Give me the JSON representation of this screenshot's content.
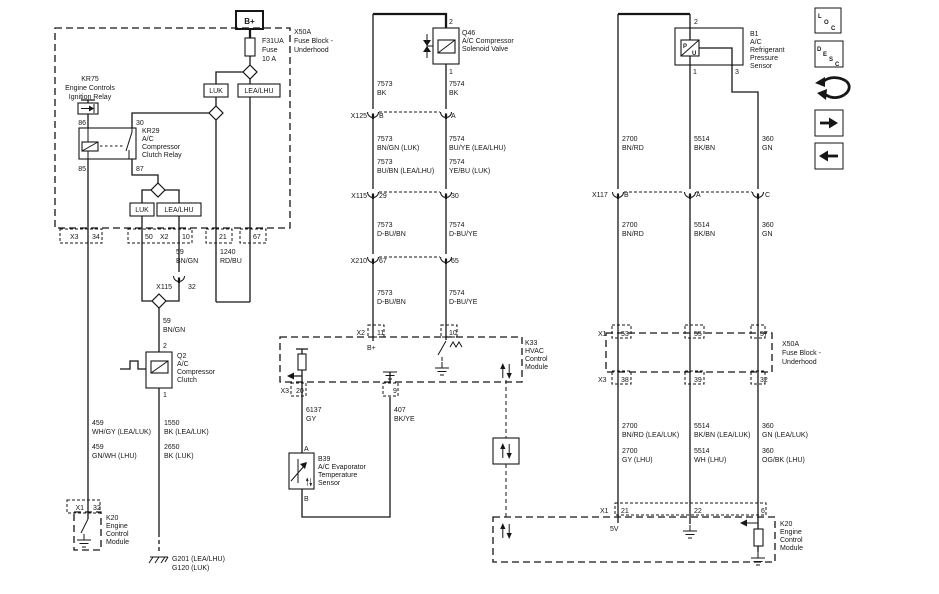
{
  "left": {
    "b_plus": "B+",
    "fuse_block_name": [
      "X50A",
      "Fuse Block -",
      "Underhood"
    ],
    "fuse": [
      "F31UA",
      "Fuse",
      "10 A"
    ],
    "kr75": [
      "KR75",
      "Engine Controls",
      "Ignition Relay"
    ],
    "kr29_pins": [
      "86",
      "30",
      "85",
      "87"
    ],
    "kr29": [
      "KR29",
      "A/C",
      "Compressor",
      "Clutch Relay"
    ],
    "variant_top": [
      "LUK",
      "LEA/LHU"
    ],
    "variant_bottom": [
      "LUK",
      "LEA/LHU"
    ],
    "block_pins": [
      "X3",
      "34",
      "50",
      "X2",
      "10",
      "21",
      "67"
    ],
    "w59_upper": [
      "59",
      "BN/GN"
    ],
    "w1240": [
      "1240",
      "RD/BU"
    ],
    "x115": [
      "X115",
      "32"
    ],
    "w59_lower": [
      "59",
      "BN/GN"
    ],
    "q2_pins": [
      "2",
      "1"
    ],
    "q2": [
      "Q2",
      "A/C",
      "Compressor",
      "Clutch"
    ],
    "w459_a": [
      "459",
      "WH/GY (LEA/LUK)"
    ],
    "w459_b": [
      "459",
      "GN/WH (LHU)"
    ],
    "w1550": [
      "1550",
      "BK (LEA/LUK)"
    ],
    "w2650": [
      "2650",
      "BK (LUK)"
    ],
    "x1": [
      "X1",
      "32"
    ],
    "k20": [
      "K20",
      "Engine",
      "Control",
      "Module"
    ],
    "grounds": [
      "G201 (LEA/LHU)",
      "G120 (LUK)"
    ]
  },
  "middle": {
    "q46_pins": [
      "2",
      "1"
    ],
    "q46": [
      "Q46",
      "A/C Compressor",
      "Solenoid Valve"
    ],
    "w7573_bk": [
      "7573",
      "BK"
    ],
    "w7574_bk": [
      "7574",
      "BK"
    ],
    "x125": [
      "X125",
      "B",
      "A"
    ],
    "w7573_a": [
      "7573",
      "BN/GN (LUK)"
    ],
    "w7574_a": [
      "7574",
      "BU/YE (LEA/LHU)"
    ],
    "w7573_b": [
      "7573",
      "BU/BN (LEA/LHU)"
    ],
    "w7574_b": [
      "7574",
      "YE/BU (LUK)"
    ],
    "x115": [
      "X115",
      "29",
      "30"
    ],
    "w7573_c": [
      "7573",
      "D-BU/BN"
    ],
    "w7574_c": [
      "7574",
      "D-BU/YE"
    ],
    "x210": [
      "X210",
      "67",
      "65"
    ],
    "w7573_d": [
      "7573",
      "D-BU/BN"
    ],
    "w7574_d": [
      "7574",
      "D-BU/YE"
    ],
    "x2": [
      "X2",
      "11",
      "10"
    ],
    "b_plus": "B+",
    "k33": [
      "K33",
      "HVAC",
      "Control",
      "Module"
    ],
    "x3": [
      "X3",
      "20"
    ],
    "pin9": "9",
    "w6137": [
      "6137",
      "GY"
    ],
    "w407": [
      "407",
      "BK/YE"
    ],
    "b39_pins": [
      "A",
      "B"
    ],
    "b39": [
      "B39",
      "A/C Evaporator",
      "Temperature",
      "Sensor"
    ]
  },
  "right": {
    "b1_pins": [
      "2",
      "1",
      "3"
    ],
    "b1_letters": [
      "P",
      "U"
    ],
    "b1": [
      "B1",
      "A/C",
      "Refrigerant",
      "Pressure",
      "Sensor"
    ],
    "w2700_a": [
      "2700",
      "BN/RD"
    ],
    "w5514_a": [
      "5514",
      "BK/BN"
    ],
    "w360_a": [
      "360",
      "GN"
    ],
    "x117": [
      "X117",
      "B",
      "A",
      "C"
    ],
    "w2700_b": [
      "2700",
      "BN/RD"
    ],
    "w5514_b": [
      "5514",
      "BK/BN"
    ],
    "w360_b": [
      "360",
      "GN"
    ],
    "x1_fuse": [
      "X1",
      "53",
      "55",
      "57"
    ],
    "fuse_block_name": [
      "X50A",
      "Fuse Block -",
      "Underhood"
    ],
    "x3_fuse": [
      "X3",
      "38",
      "39",
      "32"
    ],
    "w2700_c": [
      "2700",
      "BN/RD (LEA/LUK)"
    ],
    "w2700_d": [
      "2700",
      "GY (LHU)"
    ],
    "w5514_c": [
      "5514",
      "BK/BN (LEA/LUK)"
    ],
    "w5514_d": [
      "5514",
      "WH (LHU)"
    ],
    "w360_c": [
      "360",
      "GN (LEA/LUK)"
    ],
    "w360_d": [
      "360",
      "OG/BK (LHU)"
    ],
    "x1_k20": [
      "X1",
      "21",
      "22",
      "6"
    ],
    "five_v": "5V",
    "k20": [
      "K20",
      "Engine",
      "Control",
      "Module"
    ]
  },
  "toolbar": {
    "loc": [
      "L",
      "O",
      "C"
    ],
    "desc": [
      "D",
      "E",
      "S",
      "C"
    ]
  }
}
